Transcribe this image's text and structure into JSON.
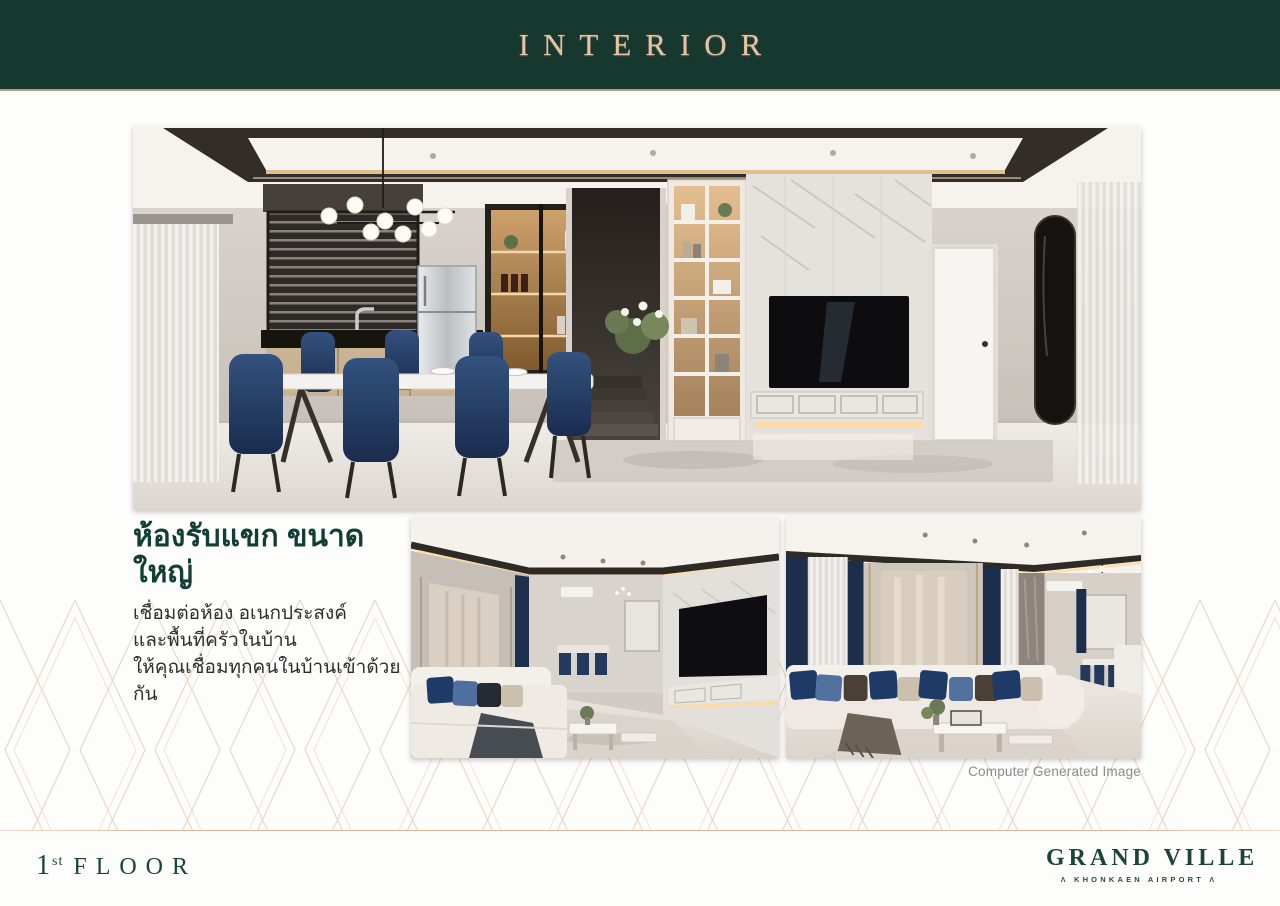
{
  "header": {
    "title": "INTERIOR"
  },
  "description": {
    "heading": "ห้องรับแขก ขนาดใหญ่",
    "lines": [
      "เชื่อมต่อห้อง อเนกประสงค์",
      "และพื้นที่ครัวในบ้าน",
      "ให้คุณเชื่อมทุกคนในบ้านเข้าด้วยกัน"
    ]
  },
  "photos": {
    "caption": "Computer Generated Image",
    "main": "dining-kitchen-and-tv-wall-render",
    "small_left": "living-room-perspective-render",
    "small_right": "living-room-sofa-render"
  },
  "footer": {
    "floor_number": "1",
    "floor_ordinal": "st",
    "floor_word": "FLOOR",
    "brand": "GRAND VILLE",
    "brand_mark": "Λ",
    "brand_subtitle": "KHONKAEN AIRPORT"
  },
  "colors": {
    "header_green": "#16382f",
    "title_rose_gold": "#e9c2a2",
    "band_rule_gold": "#b49a83",
    "footer_rule_rose": "#ddb69c",
    "heading_green": "#123f33",
    "body_text": "#2e2e2e",
    "caption_gray": "#8b8b8b",
    "brand_green": "#1c4538",
    "pattern_line": "#e8d4c4",
    "pillow_navy": "#1e3a66"
  }
}
